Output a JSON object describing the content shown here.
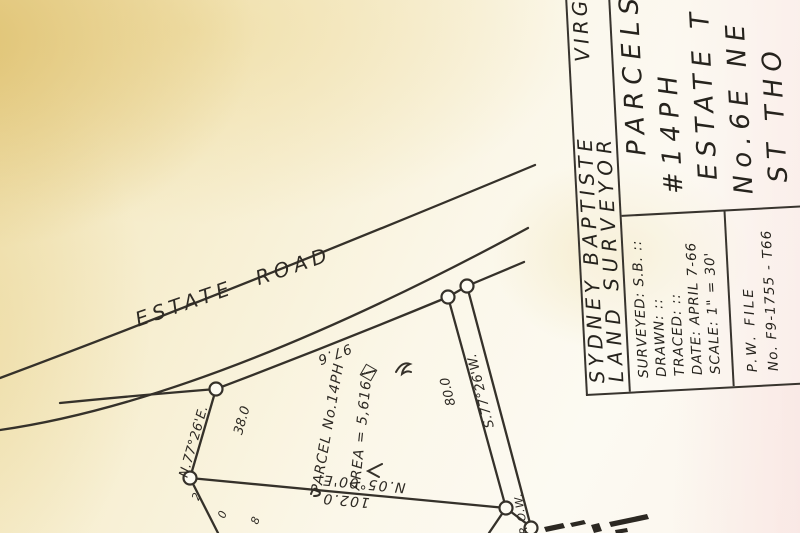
{
  "map": {
    "road_label": "ESTATE ROAD",
    "frontage_distance": "97.6",
    "parcel_label": "PARCEL No.14PH",
    "area_label": "AREA = 5,616",
    "left_boundary": {
      "bearing": "N.77°26'E.",
      "distance": "38.0"
    },
    "row_boundary": {
      "bearing": "S.77°26'W.",
      "distance": "80.0",
      "label": "R.O.W."
    },
    "rear_boundary": {
      "bearing": "N.05°00'E.",
      "distance": "102.0"
    },
    "fragments": {
      "a": "2",
      "b": "0",
      "c": "8"
    }
  },
  "title_block": {
    "surveyor": {
      "line1": "SYDNEY BAPTISTE",
      "line2": "LAND SURVEYOR",
      "fragment": "VIRG"
    },
    "description": {
      "lines": [
        "PARCELS",
        "#14PH",
        "ESTATE T",
        "No.6E NE",
        "ST THO"
      ]
    },
    "details": {
      "surveyed": "SURVEYED: S.B. ::",
      "drawn": "DRAWN: ::",
      "traced": "TRACED: ::",
      "date": "DATE: APRIL 7-66",
      "scale": "SCALE: 1\" = 30'"
    },
    "file": {
      "line1": "P.W. FILE",
      "line2": "No. F9-1755 - T66"
    }
  }
}
